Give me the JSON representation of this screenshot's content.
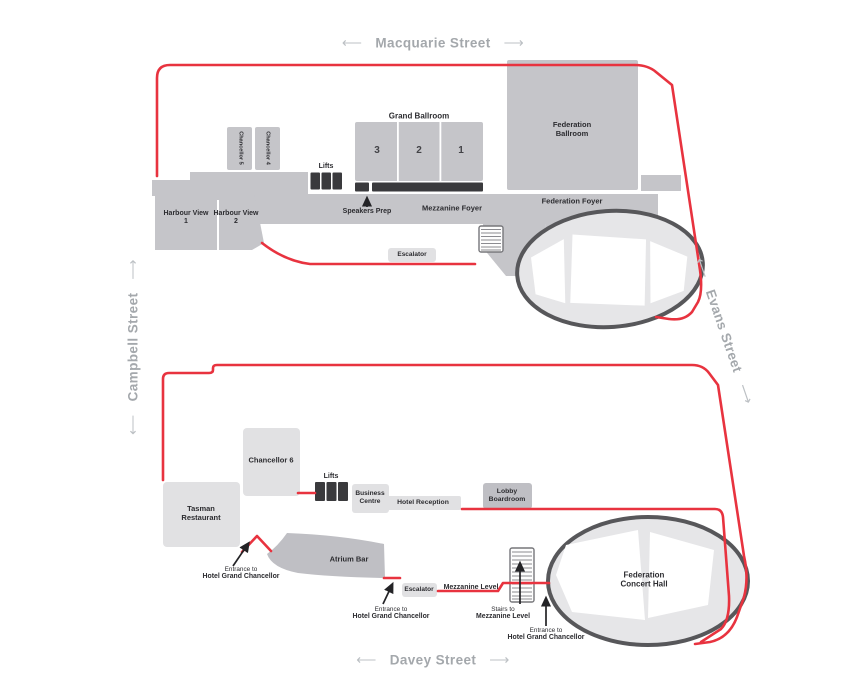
{
  "colors": {
    "route_red": "#e8333f",
    "room_gray": "#c5c5c9",
    "room_gray2": "#bfbfc4",
    "room_light": "#e1e1e3",
    "dark": "#3a3a3d",
    "oval_fill": "#e6e6e8",
    "oval_stroke": "#57575a",
    "street_text": "#a4a8ac"
  },
  "icons": {
    "arrow_left": "⟵",
    "arrow_right": "⟶"
  },
  "streets": {
    "macquarie": "Macquarie Street",
    "campbell": "Campbell Street",
    "evans": "Evans Street",
    "davey": "Davey Street"
  },
  "upper_level": {
    "grand_ballroom": {
      "title": "Grand Ballroom",
      "sections": [
        "3",
        "2",
        "1"
      ]
    },
    "federation_ballroom": "Federation Ballroom",
    "chancellor_5": "Chancellor 5",
    "chancellor_4": "Chancellor 4",
    "harbour_view_1": "Harbour View 1",
    "harbour_view_2": "Harbour View 2",
    "lifts": "Lifts",
    "speakers_prep": "Speakers Prep",
    "mezzanine_foyer": "Mezzanine Foyer",
    "federation_foyer": "Federation Foyer",
    "escalator": "Escalator"
  },
  "lower_level": {
    "chancellor_6": "Chancellor 6",
    "tasman_restaurant": "Tasman Restaurant",
    "lifts": "Lifts",
    "business_centre": "Business Centre",
    "hotel_reception": "Hotel Reception",
    "lobby_boardroom": "Lobby Boardroom",
    "atrium_bar": "Atrium Bar",
    "escalator": "Escalator",
    "mezzanine_level": "Mezzanine Level",
    "federation_concert_hall": "Federation Concert Hall",
    "entrance_1": {
      "line1": "Entrance to",
      "line2": "Hotel Grand Chancellor"
    },
    "entrance_2": {
      "line1": "Entrance to",
      "line2": "Hotel Grand Chancellor"
    },
    "entrance_3": {
      "line1": "Entrance to",
      "line2": "Hotel Grand Chancellor"
    },
    "stairs_note": {
      "line1": "Stairs to",
      "line2": "Mezzanine Level"
    }
  }
}
